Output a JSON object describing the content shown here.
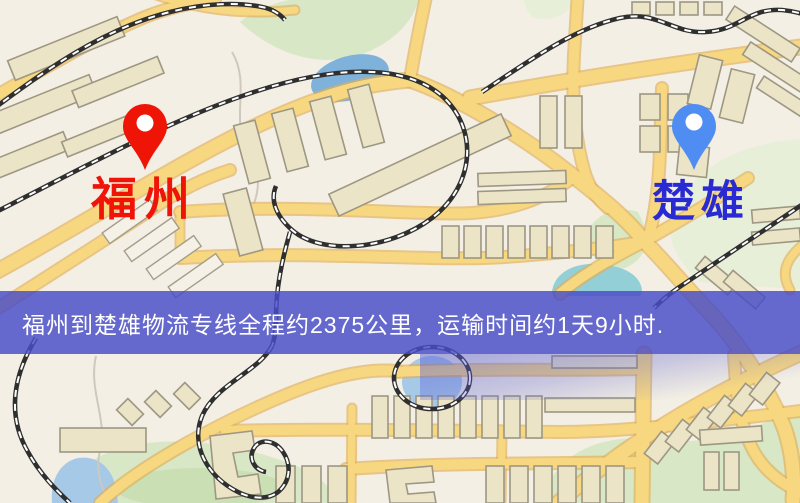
{
  "map": {
    "type": "stylized-street-map",
    "markers": [
      {
        "id": "origin",
        "label": "福州",
        "pin_color": "#ee1506",
        "label_color": "#ef1407"
      },
      {
        "id": "destination",
        "label": "楚雄",
        "pin_color": "#4f8df2",
        "label_color": "#2a2ad2"
      }
    ],
    "palette": {
      "background": "#f3efe4",
      "road": "#f7d880",
      "road_casing": "#e2ad55",
      "railway": "#2f2f2f",
      "building": "#ece4c6",
      "park": "#d8e7c6",
      "water": "#a6c9e8"
    }
  },
  "banner": {
    "text": "福州到楚雄物流专线全程约2375公里，运输时间约1天9小时.",
    "background_color": "#4a4ec4",
    "text_color": "#ffffff"
  }
}
